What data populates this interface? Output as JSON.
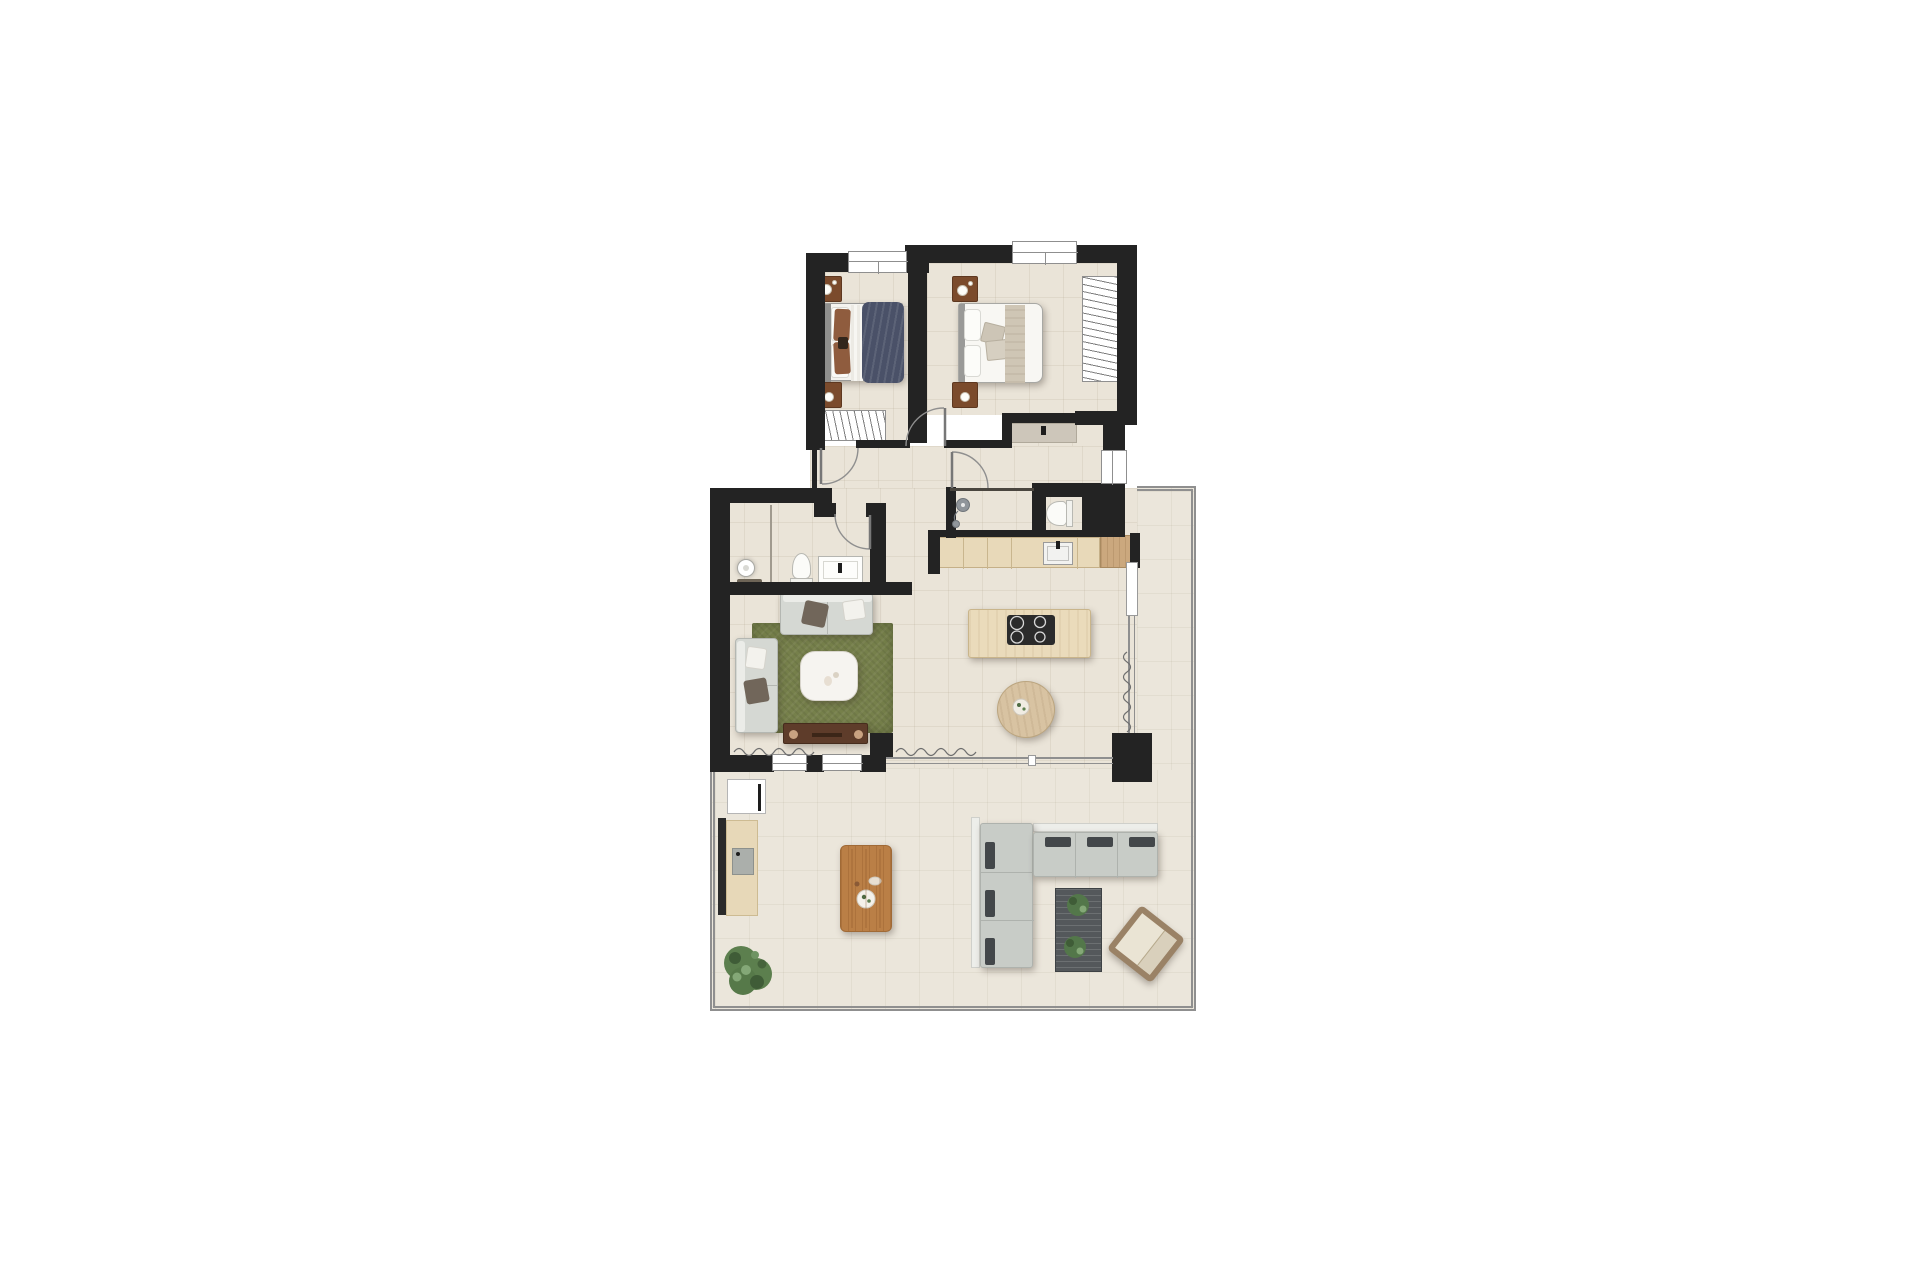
{
  "meta": {
    "description": "Top-down rendered floor plan of a two-bedroom apartment with open kitchen-living area and large wrap-around terrace, on a white background",
    "canvas": {
      "width": 1920,
      "height": 1280
    },
    "visible_text": "none"
  },
  "palette": {
    "background": "#FFFFFF",
    "walls": "#232323",
    "interior_floor": "#EAE4D8",
    "terrace_floor": "#EBE6DB",
    "terrace_edge_line": "#8F8F8F",
    "rug_green": "#76804B",
    "navy_blanket": "#4A5168",
    "beige_blanket": "#CFC6B5",
    "wood_dark": "#7B4B2C",
    "wood_console": "#5E3C2A",
    "wood_counter": "#E8D9B9",
    "wood_counter_end": "#CBA87E",
    "wood_outdoor_table": "#BA7F46",
    "sofa_gray": "#D5D8D3",
    "outdoor_sofa_gray": "#C8CCC7",
    "outdoor_pillow_dark": "#43474A",
    "outdoor_rug_dark": "#54585B",
    "plant_green": "#5C7F4E",
    "cooktop_black": "#2B2B2B"
  },
  "counts": {
    "bedrooms": 2,
    "bathrooms": 2,
    "indoor_dining_chairs": 4,
    "outdoor_dining_chairs": 6,
    "terrace_sofa_back_pillows": 6,
    "windows_top": 2,
    "door_swings": 4
  },
  "rooms": {
    "bedroom_primary": {
      "label": "bedroom-with-navy-bed",
      "furniture": [
        "double-bed-navy-blanket",
        "nightstand-with-lamp",
        "nightstand-with-lamp",
        "open-wardrobe-hatched"
      ]
    },
    "bedroom_second": {
      "label": "bedroom-with-beige-bed",
      "furniture": [
        "double-bed-beige-blanket",
        "nightstand-with-lamp",
        "nightstand-with-lamp",
        "tall-wardrobe-hatched",
        "sideboard"
      ]
    },
    "bathroom_main": {
      "label": "bathroom-left",
      "furniture": [
        "round-pedestal-basin",
        "toilet",
        "vanity-basin"
      ]
    },
    "shower_room": {
      "label": "shower-room-and-wc",
      "furniture": [
        "shower-fixture",
        "toilet"
      ]
    },
    "kitchen": {
      "label": "kitchen",
      "furniture": [
        "counter-with-sink",
        "island-with-cooktop"
      ]
    },
    "dining": {
      "label": "dining-area",
      "furniture": [
        "round-table",
        "chair",
        "chair",
        "chair",
        "chair"
      ]
    },
    "living": {
      "label": "living-room",
      "furniture": [
        "sofa-top",
        "sofa-left",
        "green-rug",
        "white-coffee-table",
        "tv-console"
      ]
    },
    "terrace": {
      "label": "terrace",
      "furniture": [
        "storage-box",
        "outdoor-counter-grill",
        "outdoor-dining-table",
        "six-chairs",
        "potted-plant",
        "l-shaped-outdoor-sofa",
        "dark-striped-rug",
        "two-plants",
        "lounge-chair-rotated"
      ]
    }
  }
}
